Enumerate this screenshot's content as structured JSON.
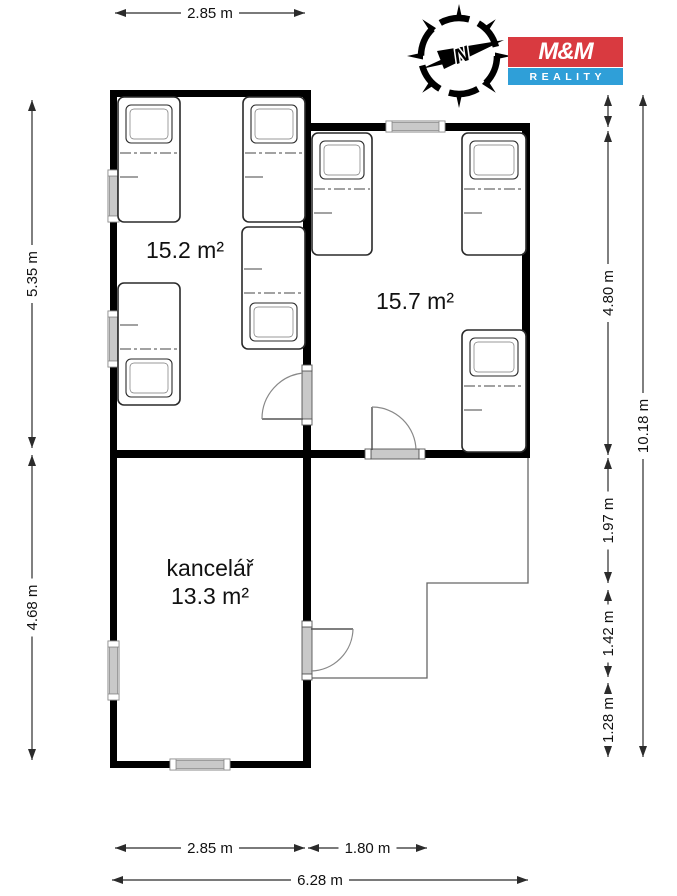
{
  "logo": {
    "line1": "M&M",
    "line2": "REALITY",
    "red": "#d93a40",
    "blue": "#2f9fd8"
  },
  "compass": {
    "label": "N"
  },
  "colors": {
    "wall": "#000000",
    "dim": "#2b2b2b",
    "text": "#111111",
    "window_fill": "#c9c9c9",
    "frame_stroke": "#8a8a8a",
    "door_stroke": "#555555",
    "arc_stroke": "#888888",
    "thin_outline": "#666666",
    "bed_stroke": "#2a2a2a",
    "bg": "#ffffff"
  },
  "rooms": [
    {
      "name": "",
      "area": "15.2 m²"
    },
    {
      "name": "",
      "area": "15.7 m²"
    },
    {
      "name": "kancelář",
      "area": "13.3 m²"
    }
  ],
  "plan": {
    "walls": [
      [
        110,
        90,
        7,
        80
      ],
      [
        110,
        222,
        7,
        89
      ],
      [
        110,
        367,
        7,
        274
      ],
      [
        110,
        700,
        7,
        68
      ],
      [
        110,
        90,
        200,
        7
      ],
      [
        303,
        90,
        8,
        280
      ],
      [
        303,
        420,
        8,
        207
      ],
      [
        303,
        674,
        8,
        94
      ],
      [
        305,
        123,
        81,
        8
      ],
      [
        445,
        123,
        85,
        8
      ],
      [
        522,
        123,
        8,
        335
      ],
      [
        110,
        450,
        261,
        8
      ],
      [
        419,
        450,
        111,
        8
      ],
      [
        110,
        761,
        60,
        7
      ],
      [
        230,
        761,
        80,
        7
      ]
    ],
    "windows": [
      {
        "o": "v",
        "x": 110,
        "y": 170,
        "len": 52
      },
      {
        "o": "v",
        "x": 110,
        "y": 311,
        "len": 56
      },
      {
        "o": "h",
        "y": 123,
        "x": 386,
        "len": 59
      },
      {
        "o": "v",
        "x": 110,
        "y": 641,
        "len": 59
      },
      {
        "o": "h",
        "y": 761,
        "x": 170,
        "len": 60
      }
    ],
    "doors": [
      {
        "sill": [
          302,
          370,
          10,
          50
        ],
        "caps": [
          [
            302,
            365,
            10,
            6
          ],
          [
            302,
            419,
            10,
            6
          ]
        ],
        "leaf": [
          303,
          419,
          262,
          419
        ],
        "arc": "M262,419 A46,46 0 0 1 303,373"
      },
      {
        "sill": [
          371,
          449,
          48,
          10
        ],
        "caps": [
          [
            365,
            449,
            6,
            10
          ],
          [
            419,
            449,
            6,
            10
          ]
        ],
        "leaf": [
          372,
          450,
          372,
          407
        ],
        "arc": "M372,407 A44,44 0 0 1 416,450"
      },
      {
        "sill": [
          302,
          627,
          10,
          47
        ],
        "caps": [
          [
            302,
            621,
            10,
            6
          ],
          [
            302,
            674,
            10,
            6
          ]
        ],
        "leaf": [
          311,
          629,
          353,
          629
        ],
        "arc": "M353,629 A43,43 0 0 1 311,671"
      }
    ],
    "beds": [
      {
        "x": 118,
        "y": 97,
        "w": 62,
        "h": 125,
        "pillow": "top"
      },
      {
        "x": 243,
        "y": 97,
        "w": 62,
        "h": 125,
        "pillow": "top"
      },
      {
        "x": 242,
        "y": 227,
        "w": 63,
        "h": 122,
        "pillow": "bottom"
      },
      {
        "x": 118,
        "y": 283,
        "w": 62,
        "h": 122,
        "pillow": "bottom"
      },
      {
        "x": 312,
        "y": 133,
        "w": 60,
        "h": 122,
        "pillow": "top"
      },
      {
        "x": 462,
        "y": 133,
        "w": 64,
        "h": 122,
        "pillow": "top"
      },
      {
        "x": 462,
        "y": 330,
        "w": 64,
        "h": 122,
        "pillow": "top"
      }
    ],
    "open_area_outline": "528,458 528,583 427,583 427,678 311,678",
    "room_labels": [
      {
        "text": "15.2 m²",
        "x": 185,
        "y": 258
      },
      {
        "text": "15.7 m²",
        "x": 415,
        "y": 309
      },
      {
        "text": "kancelář",
        "x": 210,
        "y": 576
      },
      {
        "text": "13.3 m²",
        "x": 210,
        "y": 604
      }
    ]
  },
  "dims": [
    {
      "x1": 115,
      "y1": 13,
      "x2": 305,
      "y2": 13,
      "label": "2.85 m"
    },
    {
      "x1": 32,
      "y1": 100,
      "x2": 32,
      "y2": 448,
      "label": "5.35 m"
    },
    {
      "x1": 32,
      "y1": 455,
      "x2": 32,
      "y2": 760,
      "label": "4.68 m"
    },
    {
      "x1": 608,
      "y1": 95,
      "x2": 608,
      "y2": 127,
      "label": ""
    },
    {
      "x1": 608,
      "y1": 131,
      "x2": 608,
      "y2": 455,
      "label": "4.80 m"
    },
    {
      "x1": 608,
      "y1": 458,
      "x2": 608,
      "y2": 583,
      "label": "1.97 m"
    },
    {
      "x1": 608,
      "y1": 590,
      "x2": 608,
      "y2": 677,
      "label": "1.42 m"
    },
    {
      "x1": 608,
      "y1": 683,
      "x2": 608,
      "y2": 757,
      "label": "1.28 m"
    },
    {
      "x1": 643,
      "y1": 95,
      "x2": 643,
      "y2": 757,
      "label": "10.18 m"
    },
    {
      "x1": 115,
      "y1": 848,
      "x2": 305,
      "y2": 848,
      "label": "2.85 m"
    },
    {
      "x1": 308,
      "y1": 848,
      "x2": 427,
      "y2": 848,
      "label": "1.80 m"
    },
    {
      "x1": 112,
      "y1": 880,
      "x2": 528,
      "y2": 880,
      "label": "6.28 m"
    }
  ]
}
